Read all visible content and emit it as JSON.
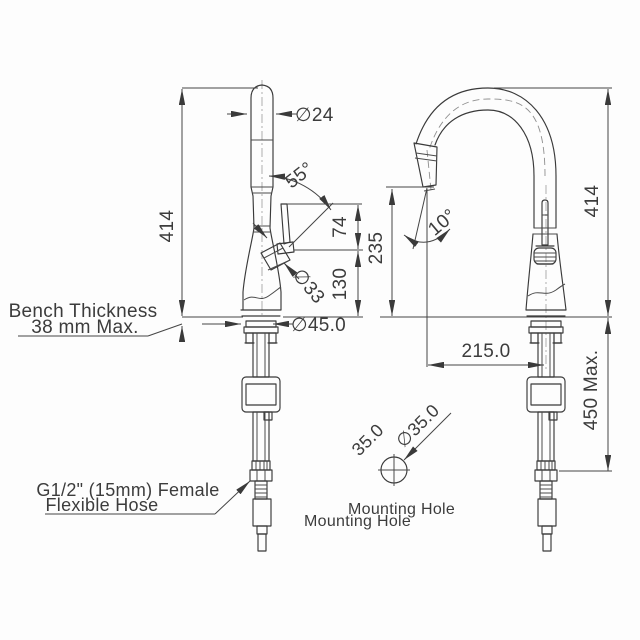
{
  "drawing": {
    "left_view": {
      "height": "414",
      "spout_diameter": "∅24",
      "lever_angle": "55°",
      "lever_travel": "74",
      "spout_to_bench": "130",
      "body_diameter": "∅33",
      "base_diameter": "∅45.0",
      "bench_note": [
        "Bench Thickness",
        "38 mm Max."
      ],
      "hose_note": [
        "G1/2\" (15mm) Female",
        "Flexible Hose"
      ]
    },
    "right_view": {
      "height": "414",
      "spout_outlet_height": "235",
      "head_angle": "10°",
      "spout_reach": "215.0",
      "hose_length": "450 Max.",
      "mounting_hole_width": "35.0",
      "mounting_hole_diameter": "∅35.0",
      "mounting_hole_labels": [
        "Mounting Hole",
        "Mounting Hole"
      ]
    },
    "colors": {
      "line": "#3a3a3a",
      "text": "#3c3c3c",
      "background": "#fdfdfd"
    }
  }
}
